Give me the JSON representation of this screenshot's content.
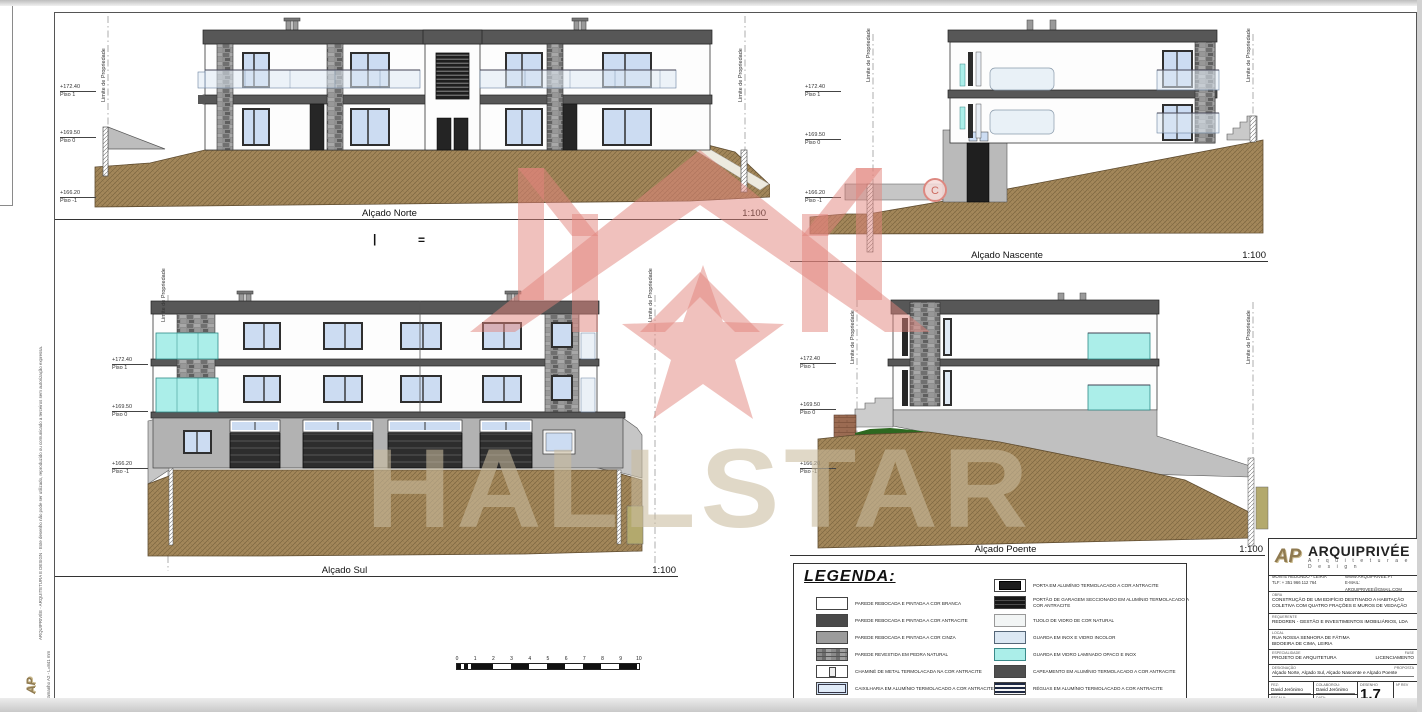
{
  "elevations": {
    "norte": {
      "title": "Alçado Norte",
      "scale": "1:100"
    },
    "nascente": {
      "title": "Alçado Nascente",
      "scale": "1:100"
    },
    "sul": {
      "title": "Alçado Sul",
      "scale": "1:100"
    },
    "poente": {
      "title": "Alçado Poente",
      "scale": "1:100"
    }
  },
  "levels": {
    "p1": {
      "elev": "+172.40",
      "name": "Piso 1"
    },
    "p0": {
      "elev": "+169.50",
      "name": "Piso 0"
    },
    "pm1": {
      "elev": "+166.20",
      "name": "Piso -1"
    }
  },
  "property_line_label": "Limite de Propriedade",
  "marks": {
    "bar": "|",
    "equals": "=",
    "bubble": "C"
  },
  "scalebar": {
    "ticks": [
      "0",
      "1",
      "2",
      "3",
      "4",
      "5",
      "6",
      "7",
      "8",
      "9",
      "10"
    ]
  },
  "watermark": {
    "text": "HALLSTAR"
  },
  "margin": {
    "disclaimer": "ARQUIPRIVÉE - ARQUITETURA E DESIGN · Este desenho não pode ser utilizado, reproduzido ou comunicado a terceiros sem autorização expressa.",
    "size_note": "Tamanho A2 - L=841 mm",
    "logo": "AP"
  },
  "legend": {
    "title": "LEGENDA:",
    "left_items": [
      {
        "swatch": "white",
        "label": "PAREDE REBOCADA E PINTADA A COR BRANCA"
      },
      {
        "swatch": "antracite",
        "label": "PAREDE REBOCADA E PINTADA A COR ANTRACITE"
      },
      {
        "swatch": "cinza",
        "label": "PAREDE REBOCADA E PINTADA A COR CINZA"
      },
      {
        "swatch": "pedra",
        "label": "PAREDE REVESTIDA EM PEDRA NATURAL"
      },
      {
        "swatch": "chamine",
        "label": "CHAMINÉ DE METAL TERMOLACADA NA COR ANTRACITE"
      },
      {
        "swatch": "caixilharia",
        "label": "CAIXILHARIA EM ALUMÍNIO TERMOLACADO A COR ANTRACITE"
      }
    ],
    "right_items": [
      {
        "swatch": "porta",
        "label": "PORTA EM ALUMÍNIO TERMOLACADO A COR ANTRACITE"
      },
      {
        "swatch": "portao",
        "label": "PORTÃO DE GARAGEM SECCIONADO EM ALUMÍNIO TERMOLACADO A COR ANTRACITE"
      },
      {
        "swatch": "tijolo",
        "label": "TIJOLO DE VIDRO DE COR NATURAL"
      },
      {
        "swatch": "guarda-inox",
        "label": "GUARDA EM INOX E VIDRO INCOLOR"
      },
      {
        "swatch": "guarda-vidro",
        "label": "GUARDA EM VIDRO LAMINADO OPACO E INOX"
      },
      {
        "swatch": "capeamento",
        "label": "CAPEAMENTO EM ALUMÍNIO TERMOLACADO A COR ANTRACITE"
      },
      {
        "swatch": "reguas",
        "label": "RÉGUAS EM ALUMÍNIO TERMOLACADO A COR ANTRACITE"
      }
    ]
  },
  "titleblock": {
    "logo_text": "AP",
    "firm": "ARQUIPRIVÉE",
    "firm_sub": "A r q u i t e t u r a   e   D e s i g n",
    "addr": "MONTE REDONDO - LEIRIA",
    "site": "WWW.ARQUIPRIVEE.PT",
    "phone": "TLF: + 351 966 112 764",
    "email": "E-MAIL: ARQUIPRIVEE@GMAIL.COM",
    "obra_label": "OBRA",
    "obra": "CONSTRUÇÃO DE UM EDIFÍCIO DESTINADO A HABITAÇÃO COLETIVA COM QUATRO FRAÇÕES E MUROS DE VEDAÇÃO",
    "req_label": "REQUERENTE",
    "req": "REDGREN - GESTÃO E INVESTIMENTOS IMOBILIÁRIOS, LDA",
    "local_label": "LOCAL",
    "local1": "RUA NOSSA SENHORA DE FÁTIMA",
    "local2": "BIDOEIRA DE CIMA, LEIRIA",
    "esp_label": "ESPECIALIDADE",
    "esp": "PROJETO DE ARQUITETURA",
    "fase_label": "FASE",
    "fase": "LICENCIAMENTO",
    "desig_label": "DESIGNAÇÃO",
    "desig_right": "PROPOSTA",
    "desig": "Alçado Norte, Alçado Sul, Alçado Nascente e Alçado Poente",
    "fez_label": "FEZ:",
    "fez": "David Jerónimo",
    "colab_label": "COLABOROU:",
    "colab": "David Jerónimo",
    "escala_label": "ESCALA:",
    "escala": "1:100, 1:50, 1:200",
    "data_label": "DATA:",
    "data": "Setembro de 2023",
    "desenho_label": "DESENHO",
    "desenho": "1.7",
    "rev_label": "Nº REV"
  },
  "colors": {
    "watermark_pink": "#e2837c",
    "watermark_text": "#cbbc9e",
    "soil_brown": "#a3875a",
    "cyan_guard": "#abeee9",
    "slab_gray": "#575757",
    "glass_blue": "#ccdcf2"
  }
}
